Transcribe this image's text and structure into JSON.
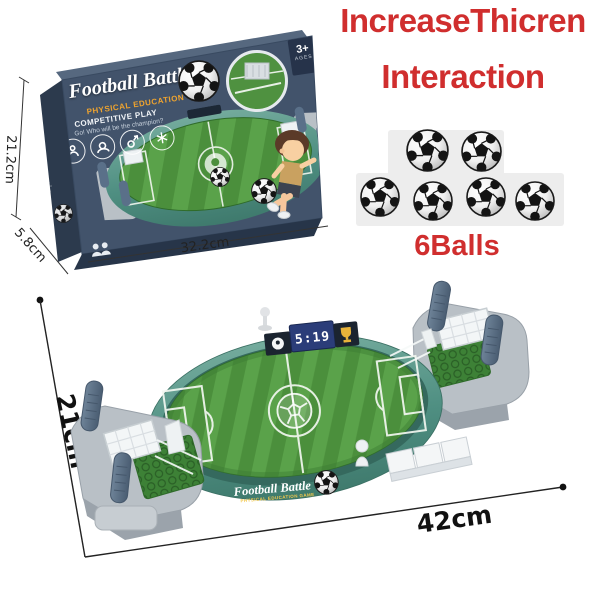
{
  "image": {
    "description": "Tabletop football battle game product photo with box, promo text and dimensions",
    "background": "#ffffff"
  },
  "promo": {
    "headline_line1": "IncreaseThicren",
    "headline_line2": "Interaction",
    "headline_color": "#d02e2e",
    "balls_label": "6Balls",
    "balls_count": 6
  },
  "box": {
    "title": "Football Battle",
    "subtitle": "PHYSICAL EDUCATION GAME",
    "tagline1": "COMPETITIVE PLAY",
    "tagline2": "Go! Who will be the champion?",
    "age_badge": "3+",
    "age_badge_label": "AGES",
    "spine_title": "Football Battle",
    "dim_height": "21.2cm",
    "dim_width": "32.2cm",
    "dim_depth": "5.8cm"
  },
  "product": {
    "wall_title": "Football Battle",
    "wall_subtitle": "PHYSICAL EDUCATION GAME",
    "scoreboard_score": "5:19",
    "dim_length": "42cm",
    "dim_width": "21cm"
  },
  "colors": {
    "box_front": "#42536b",
    "box_spine": "#2c3a4d",
    "field_dark": "#4b8f3c",
    "field_light": "#5aa24a",
    "wall_teal": "#4f8f82",
    "grip_blue": "#5a7089",
    "base_gray": "#b9c0c6"
  }
}
